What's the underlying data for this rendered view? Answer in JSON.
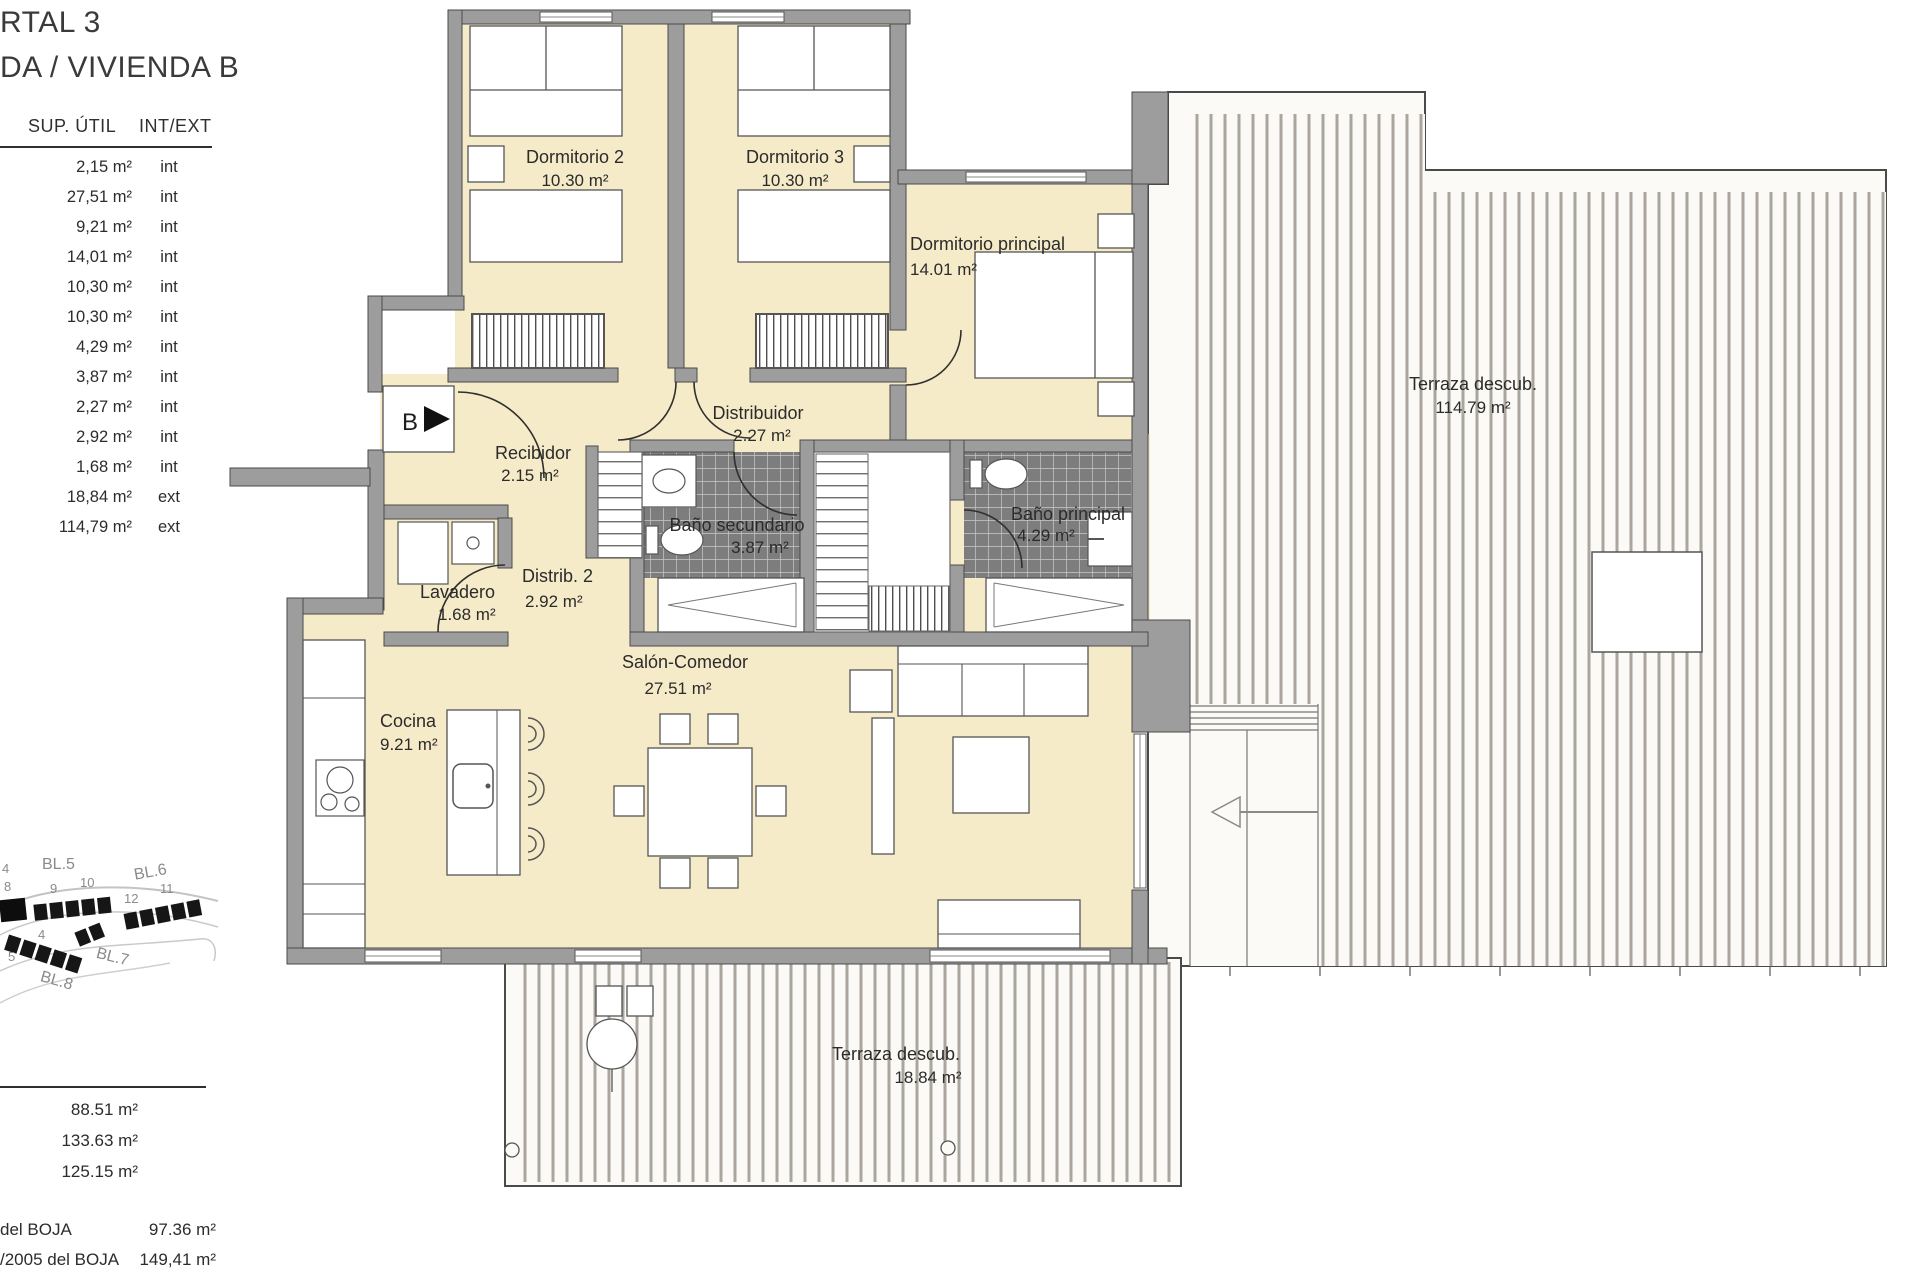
{
  "header": {
    "portal": "RTAL 3",
    "vivienda": "DA / VIVIENDA B"
  },
  "areas_table": {
    "col_area": "SUP. ÚTIL",
    "col_type": "INT/EXT",
    "rows": [
      {
        "value": "2,15 m²",
        "type": "int"
      },
      {
        "value": "27,51 m²",
        "type": "int"
      },
      {
        "value": "9,21 m²",
        "type": "int"
      },
      {
        "value": "14,01 m²",
        "type": "int"
      },
      {
        "value": "10,30 m²",
        "type": "int"
      },
      {
        "value": "10,30 m²",
        "type": "int"
      },
      {
        "value": "4,29 m²",
        "type": "int"
      },
      {
        "value": "3,87 m²",
        "type": "int"
      },
      {
        "value": "2,27 m²",
        "type": "int"
      },
      {
        "value": "2,92 m²",
        "type": "int"
      },
      {
        "value": "1,68 m²",
        "type": "int"
      },
      {
        "value": "18,84 m²",
        "type": "ext"
      },
      {
        "value": "114,79 m²",
        "type": "ext"
      }
    ]
  },
  "totals": {
    "values": [
      "88.51 m²",
      "133.63 m²",
      "125.15 m²"
    ]
  },
  "boja": {
    "rows": [
      {
        "label": "del BOJA",
        "value": "97.36 m²"
      },
      {
        "label": "/2005 del BOJA",
        "value": "149,41 m²"
      }
    ]
  },
  "site_map": {
    "labels": [
      "4",
      "BL.5",
      "10",
      "9",
      "8",
      "BL.6",
      "12",
      "11",
      "4",
      "5",
      "BL.7",
      "BL.8"
    ]
  },
  "plan": {
    "entrance": "B",
    "rooms": {
      "dormitorio2": {
        "name": "Dormitorio 2",
        "area": "10.30 m²"
      },
      "dormitorio3": {
        "name": "Dormitorio 3",
        "area": "10.30 m²"
      },
      "dormitorio_principal": {
        "name": "Dormitorio principal",
        "area": "14.01 m²"
      },
      "distribuidor": {
        "name": "Distribuidor",
        "area": "2.27 m²"
      },
      "recibidor": {
        "name": "Recibidor",
        "area": "2.15 m²"
      },
      "bano_secundario": {
        "name": "Baño secundario",
        "area": "3.87 m²"
      },
      "bano_principal": {
        "name": "Baño principal",
        "area": "4.29 m²"
      },
      "lavadero": {
        "name": "Lavadero",
        "area": "1.68 m²"
      },
      "distrib_2": {
        "name": "Distrib. 2",
        "area": "2.92 m²"
      },
      "cocina": {
        "name": "Cocina",
        "area": "9.21 m²"
      },
      "salon_comedor": {
        "name": "Salón-Comedor",
        "area": "27.51 m²"
      },
      "terraza_descubierta": {
        "name": "Terraza descub.",
        "area": "114.79 m²"
      },
      "terraza_descubierta_2": {
        "name": "Terraza descub.",
        "area": "18.84 m²"
      }
    }
  },
  "colors": {
    "room_fill": "#f6ebc9",
    "wall": "#9d9d9d",
    "bathroom_tile": "#7d7d7d",
    "terrace_bg": "#fbfaf7",
    "terrace_stripe": "#aba69d",
    "text": "#2b2b2b"
  }
}
